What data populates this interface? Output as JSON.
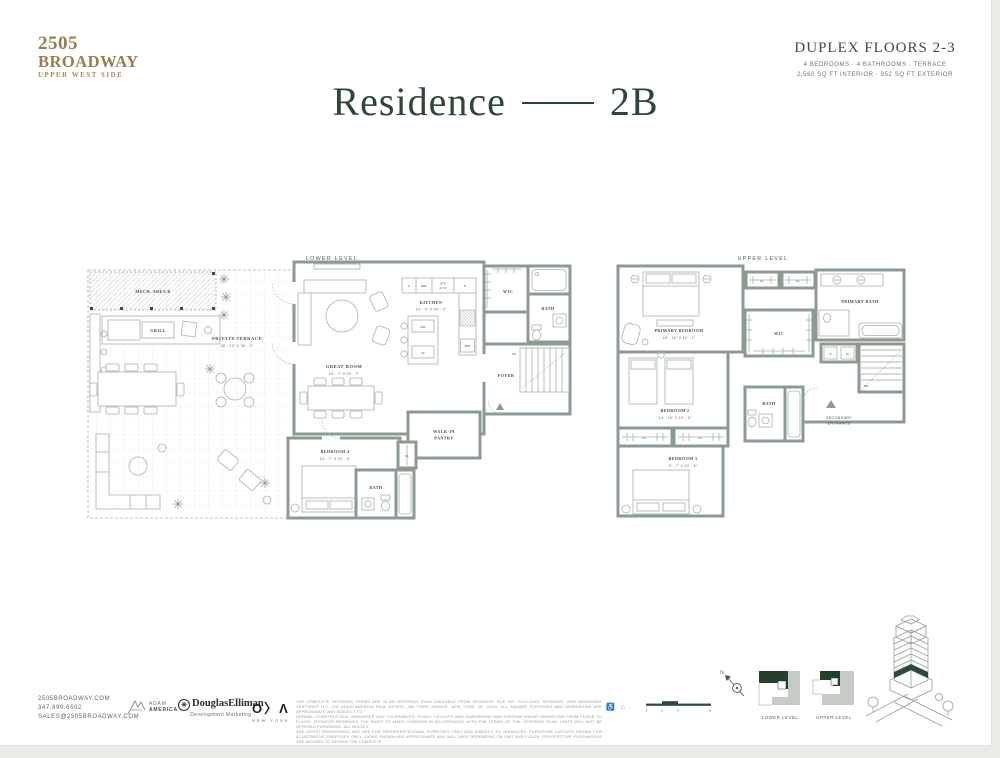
{
  "header": {
    "logo_line1": "2505",
    "logo_line2": "BROADWAY",
    "logo_line3": "UPPER WEST SIDE",
    "duplex_title": "DUPLEX FLOORS 2-3",
    "duplex_sub1": "4 BEDROOMS · 4 BATHROOMS · TERRACE",
    "duplex_sub2": "2,560 SQ FT INTERIOR · 952 SQ FT EXTERIOR",
    "residence_word": "Residence",
    "residence_unit": "2B"
  },
  "lower": {
    "label": "LOWER LEVEL",
    "mech": "MECH. AREA B",
    "grill": "GRILL",
    "terrace": "PRIVATE TERRACE",
    "terrace_dim": "28' - 10\" X 36' - 5\"",
    "great_room": "GREAT ROOM",
    "great_room_dim": "18' - 7\" X 20' - 7\"",
    "kitchen": "KITCHEN",
    "kitchen_dim": "10' - 0\" X 20' - 2\"",
    "f": "F",
    "ref": "REF",
    "sto1": "STO",
    "sto2": "& OV",
    "p": "P",
    "dw": "DW",
    "w": "W",
    "mw": "MW",
    "wic": "WIC",
    "bath1": "BATH",
    "foyer": "FOYER",
    "up": "UP",
    "pantry1": "WALK-IN",
    "pantry2": "PANTRY",
    "bedroom4": "BEDROOM 4",
    "bedroom4_dim": "10' - 7\" X 10' - 5\"",
    "bath2": "BATH",
    "cl": "CL"
  },
  "upper": {
    "label": "UPPER LEVEL",
    "primary_bedroom": "PRIMARY BEDROOM",
    "primary_bedroom_dim": "18' - 10\" X 12' - 1\"",
    "wic": "WIC",
    "primary_bath": "PRIMARY BATH",
    "d": "D",
    "w": "W",
    "dn": "DN",
    "cl1": "CL",
    "cl2": "CL",
    "cl3": "CL",
    "cl4": "CL",
    "bedroom2": "BEDROOM 2",
    "bedroom2_dim": "14' - 10\" X 10' - 5\"",
    "bedroom3": "BEDROOM 3",
    "bedroom3_dim": "9' - 7\" X 10' - 4\"",
    "bath": "BATH",
    "secondary1": "SECONDARY",
    "secondary2": "ENTRANCE"
  },
  "footer": {
    "website": "2505BROADWAY.COM",
    "phone": "347.899.6502",
    "email": "SALES@2505BROADWAY.COM",
    "adam_america_1": "ADAM",
    "adam_america_2": "AMERICA",
    "douglas": "DouglasElliman",
    "douglas_sub": "Development Marketing",
    "de_mark": "✳",
    "oda_o": "O",
    "oda_d": "〉",
    "oda_a": "Λ",
    "oda_sub": "NEW YORK",
    "disclaimer_lines": [
      "THE COMPLETE OFFERING TERMS ARE IN AN OFFERING PLAN AVAILABLE FROM SPONSOR. FILE NO. CD21-0142. SPONSOR: 2505 BROADWAY VENTURES LLC, C/O ADAM AMERICA REAL ESTATE, 850 THIRD AVENUE, NEW YORK, NY 10022. ALL SQUARE FOOTAGES AND DIMENSIONS ARE APPROXIMATE AND SUBJECT TO",
      "NORMAL CONSTRUCTION VARIANCES AND TOLERANCES. PLANS, LAYOUTS AND DIMENSIONS MAY CONTAIN MINOR VARIATIONS FROM FLOOR TO FLOOR. SPONSOR RESERVES THE RIGHT TO MAKE CHANGES IN ACCORDANCE WITH THE TERMS OF THE OFFERING PLAN. UNITS WILL NOT BE OFFERED FURNISHED. ALL IMAGES",
      "ARE ARTIST RENDERINGS AND ARE FOR REPRESENTATIONAL PURPOSES ONLY AND SUBJECT TO VARIANCES. FURNITURE LAYOUTS SHOWN FOR ILLUSTRATIVE PURPOSES ONLY. VIEWS SHOWN ARE APPROXIMATE AND WILL VARY DEPENDING ON UNIT AND FLOOR. PROSPECTIVE PURCHASERS ARE ADVISED TO REVIEW THE COMPLETE",
      "TERMS OF THE OFFERING PLAN FOR FURTHER DETAIL AS TO THE TYPE, QUALITY AND QUANTITY OF MATERIALS, APPLIANCES, EQUIPMENT AND FIXTURES TO BE INCLUDED IN THE UNITS, AMENITY SPACES AND COMMON AREAS OF THE CONDOMINIUM."
    ],
    "accessibility_icons": "♿ ⌂",
    "scale_0": "0",
    "scale_2": "2",
    "scale_4": "4",
    "scale_8": "8",
    "compass_n": "N",
    "keyplan_lower": "LOWER LEVEL",
    "keyplan_upper": "UPPER LEVEL"
  }
}
